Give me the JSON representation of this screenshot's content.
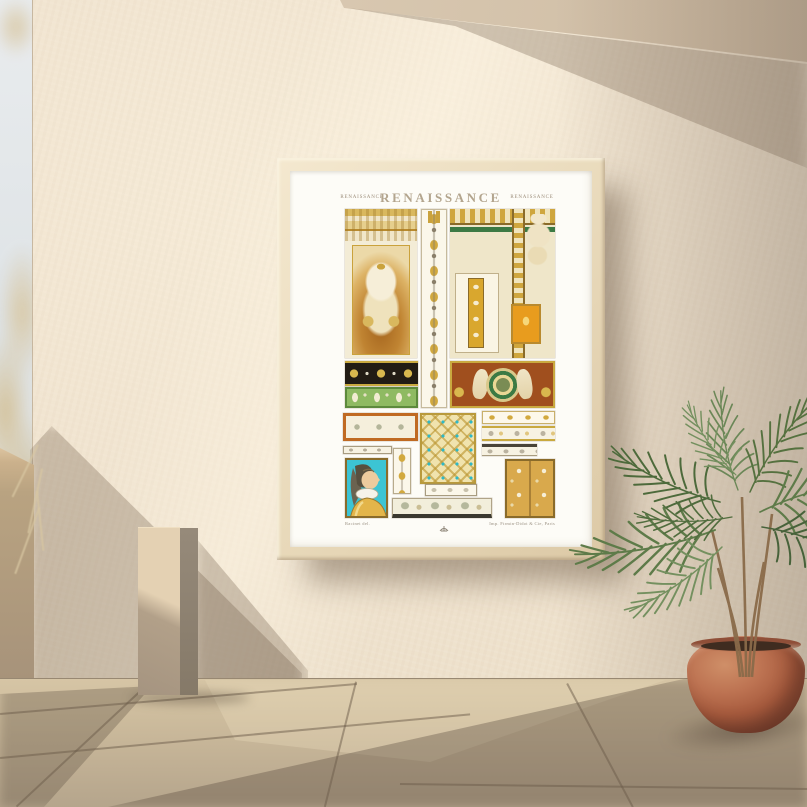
{
  "poster": {
    "heading": {
      "center": "RENAISSANCE",
      "left": "RENAISSANCE",
      "right": "RENAISSANCE"
    },
    "credits": {
      "left": "Racinet del.",
      "right": "Imp. Firmin-Didot & Cie, Paris"
    },
    "panels": [
      {
        "name": "pilaster-urn-panel",
        "desc": "gilded pilaster frame with strapwork cartouche and lidded urn on amber niche",
        "colors": [
          "#d9b85e",
          "#a5651e",
          "#f3ecd6"
        ]
      },
      {
        "name": "candelabra-strip",
        "desc": "vertical grotesque candelabra ornament, gold on cream",
        "colors": [
          "#d2a93e",
          "#fbf7ea"
        ]
      },
      {
        "name": "coffer-figure-panel",
        "desc": "ceiling cornice corner with seated ivory figure, green recesses and orange cartouche",
        "colors": [
          "#cfa63e",
          "#3c7a44",
          "#e89c1e"
        ]
      },
      {
        "name": "shell-band",
        "desc": "black band with gold shells and white rosettes",
        "colors": [
          "#221c14",
          "#d9b84e"
        ]
      },
      {
        "name": "leaf-band",
        "desc": "green band with cream palmettes",
        "colors": [
          "#8fba62",
          "#f2ecd2"
        ]
      },
      {
        "name": "mermaid-frieze",
        "desc": "russet frieze with two ivory mermaid figures flanking a green laurel medallion",
        "colors": [
          "#a04f1e",
          "#3f7a46",
          "#f0e5c6"
        ]
      },
      {
        "name": "orange-scroll-frieze",
        "desc": "white scrollwork frieze in orange frame",
        "colors": [
          "#c06a22",
          "#f5efdc"
        ]
      },
      {
        "name": "lattice-panel",
        "desc": "gold interlace lattice with teal jewels",
        "colors": [
          "#f0e3ae",
          "#ba9430",
          "#2fb8c6"
        ]
      },
      {
        "name": "thin-gold-frieze",
        "desc": "narrow running scroll, gold on white",
        "colors": [
          "#d2a93e",
          "#fdf8ea"
        ]
      },
      {
        "name": "thin-scroll-frieze",
        "desc": "narrow acanthus scroll, grey and gold",
        "colors": [
          "#8a7f6a",
          "#d2a93e"
        ]
      },
      {
        "name": "small-scroll-strip",
        "desc": "small grey rinceau strip",
        "colors": [
          "#8a7f6a",
          "#f7f2e2"
        ]
      },
      {
        "name": "portrait-panel",
        "desc": "profile portrait of a lady with veiled headdress and gold bodice on turquoise ground",
        "colors": [
          "#3cc4d4",
          "#e3b54a",
          "#eccb9e"
        ]
      },
      {
        "name": "knot-strip",
        "desc": "vertical strip of gold knot motifs",
        "colors": [
          "#d2a93e",
          "#fbf7ea"
        ]
      },
      {
        "name": "floral-gold-panel",
        "desc": "two-column gold panel with cream flowers on vines",
        "colors": [
          "#d9a94c",
          "#f6eed6"
        ]
      },
      {
        "name": "grey-scroll-strip",
        "desc": "grey scroll strip with dark top bar",
        "colors": [
          "#4a4438",
          "#f7f2e2"
        ]
      },
      {
        "name": "mini-scroll-frieze",
        "desc": "small scroll frieze",
        "colors": [
          "#968c6e",
          "#fbf7ea"
        ]
      },
      {
        "name": "bottom-scroll-frieze",
        "desc": "wide scrollwork frieze with dark base bar",
        "colors": [
          "#f2eedb",
          "#3a382f"
        ]
      }
    ]
  },
  "scene": {
    "objects": [
      "framed renaissance ornament poster",
      "sunlit stucco wall",
      "terracotta pot with palm plant",
      "stone pedestal",
      "low parapet wall",
      "beige tiled floor",
      "pale sky at left edge",
      "dried grass"
    ]
  },
  "palette": {
    "wall": "#f1e5d1",
    "wall-bright": "#f7ecd8",
    "sky": "#e9ecee",
    "soffit": "#e0d0b9",
    "shadow": "rgba(108,90,71,0.30)",
    "floor": "#d6c5a5",
    "floor-dark": "#b5a58c",
    "grout": "#6b5c4a",
    "parapet": "#b9a381",
    "pedestal": "#e4d1b3",
    "frame-wood": "#e9dabb",
    "paper": "#fdfcf7",
    "title-color": "#b3a58e",
    "caption-color": "#9b8c79",
    "gold": "#d2a93e",
    "gold-ground": "#d9a94c",
    "amber": "#a5651e",
    "russet": "#a04f1e",
    "orange-frame": "#c06a22",
    "orange-gold": "#e89c1e",
    "green-band": "#8fba62",
    "green-dark": "#3c7a44",
    "black-band": "#221c14",
    "teal": "#2fb8c6",
    "cyan": "#3cc4d4",
    "outline-grey": "#8a7f6a",
    "pot": "#bd7352",
    "pot-dark": "#7e4330",
    "soil": "#3f2c20",
    "dry-plant": "#d8c7a2",
    "palm-dark": "#4d6a3b",
    "palm-mid": "#5e7b49",
    "palm-light": "#74905f",
    "stem": "#8a6b4a"
  }
}
